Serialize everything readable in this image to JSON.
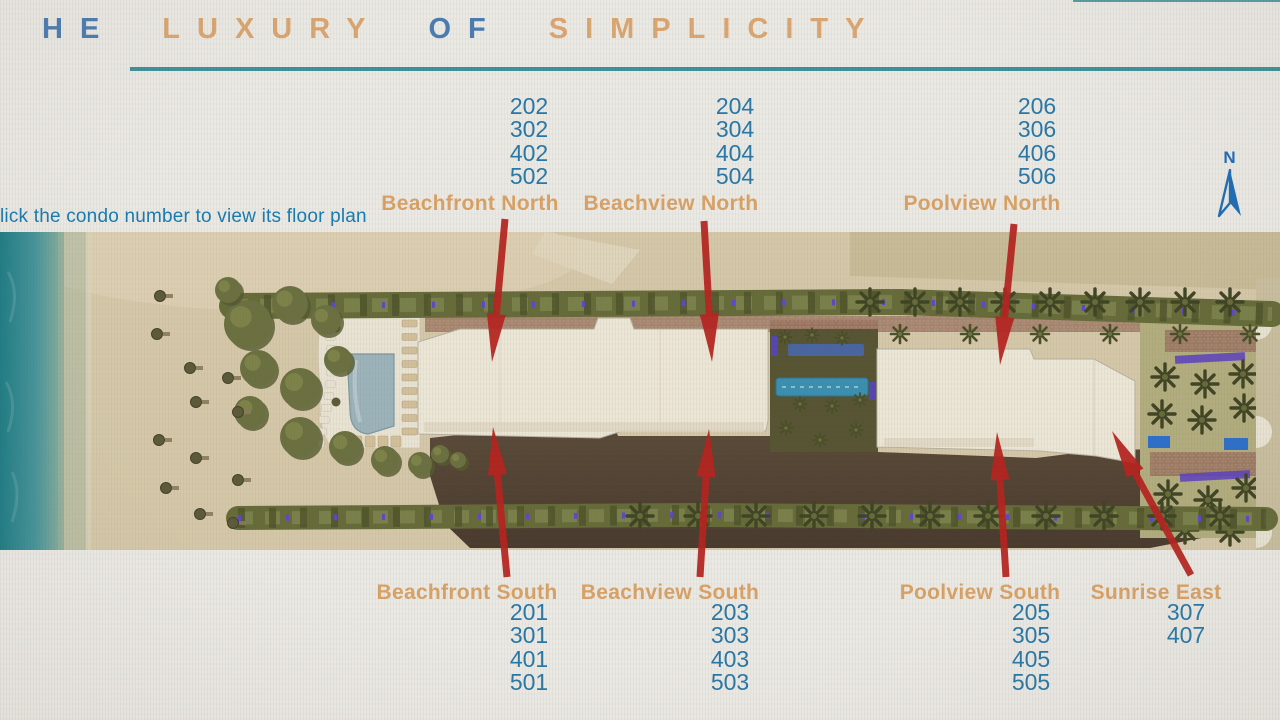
{
  "header": {
    "title_words": [
      {
        "text": "HE",
        "color": "#4b7cb1"
      },
      {
        "text": "LUXURY",
        "color": "#dba670"
      },
      {
        "text": "OF",
        "color": "#4b7cb1"
      },
      {
        "text": "SIMPLICITY",
        "color": "#dba670"
      }
    ],
    "instruction": "lick the condo number to view its floor plan"
  },
  "compass": {
    "label": "N"
  },
  "map": {
    "north_sections": [
      {
        "name": "Beachfront North",
        "units": [
          "202",
          "302",
          "402",
          "502"
        ]
      },
      {
        "name": "Beachview North",
        "units": [
          "204",
          "304",
          "404",
          "504"
        ]
      },
      {
        "name": "Poolview North",
        "units": [
          "206",
          "306",
          "406",
          "506"
        ]
      }
    ],
    "south_sections": [
      {
        "name": "Beachfront South",
        "units": [
          "201",
          "301",
          "401",
          "501"
        ]
      },
      {
        "name": "Beachview South",
        "units": [
          "203",
          "303",
          "403",
          "503"
        ]
      },
      {
        "name": "Poolview South",
        "units": [
          "205",
          "305",
          "405",
          "505"
        ]
      },
      {
        "name": "Sunrise East",
        "units": [
          "307",
          "407"
        ]
      }
    ]
  },
  "colors": {
    "unit_number_blue": "#2878a7",
    "section_label_tan": "#d9a266",
    "title_blue": "#4b7cb1",
    "title_tan": "#dba670",
    "underline_teal": "#2e8a92",
    "instruction_blue": "#177cb0",
    "arrow_red": "#b6231f",
    "compass_blue": "#1f6db5"
  }
}
